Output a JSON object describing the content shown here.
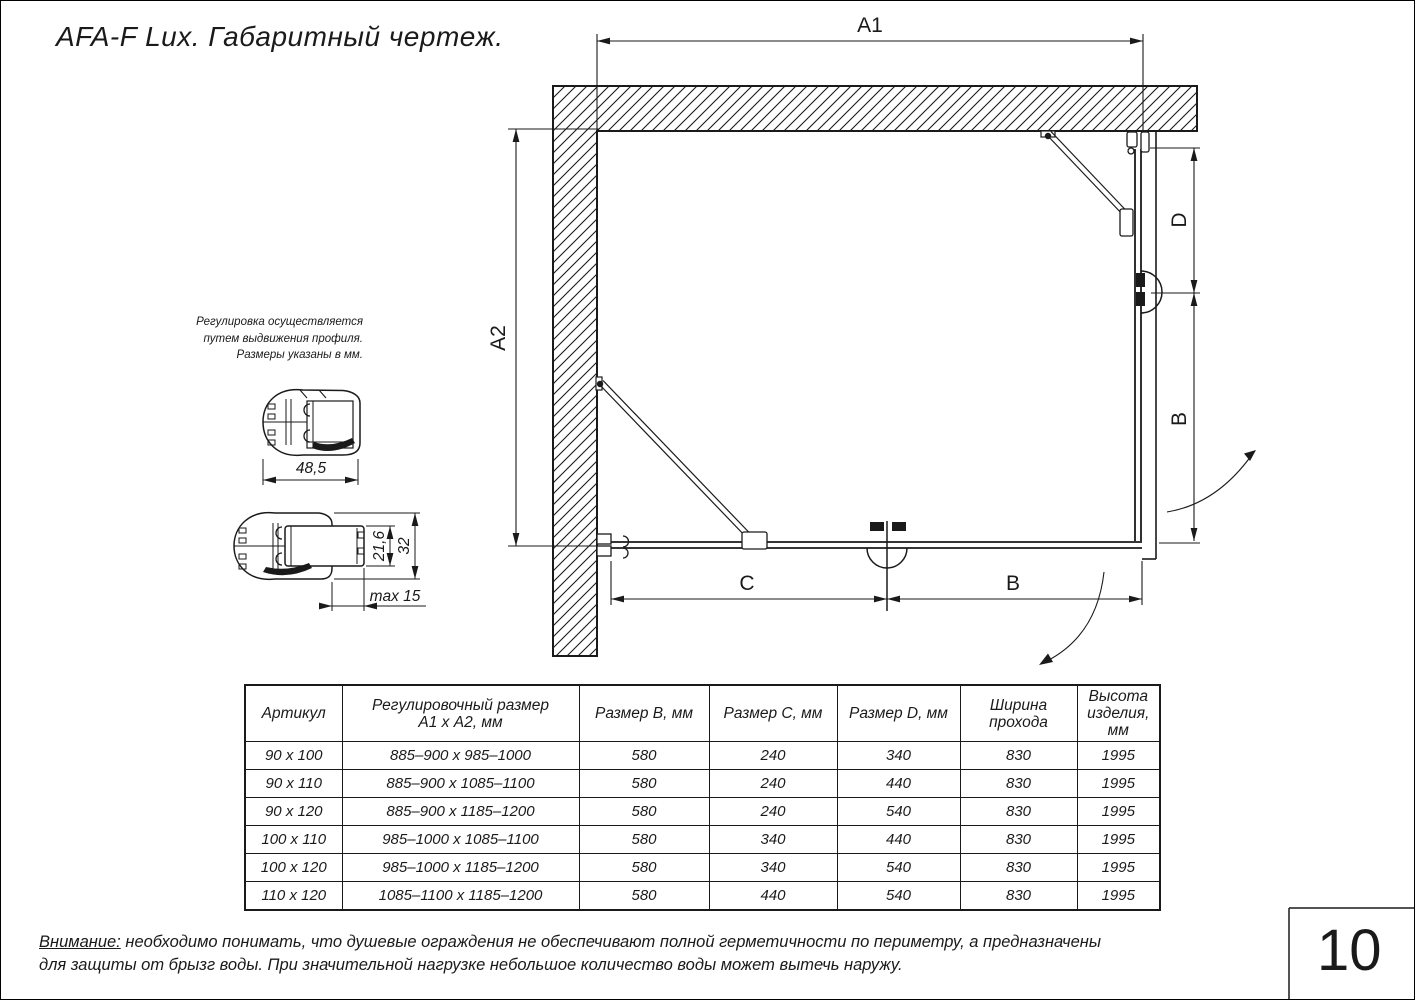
{
  "page": {
    "title": "AFA-F Lux. Габаритный чертеж.",
    "page_number": "10"
  },
  "drawing": {
    "dim_a1": "A1",
    "dim_a2": "A2",
    "dim_d": "D",
    "dim_b_right": "B",
    "dim_c": "C",
    "dim_b_bottom": "B"
  },
  "profiles": {
    "note_line1": "Регулировка осуществляется",
    "note_line2": "путем выдвижения профиля.",
    "note_line3": "Размеры указаны в мм.",
    "dim_width": "48,5",
    "dim_inner": "21,6",
    "dim_outer": "32",
    "dim_max": "max 15"
  },
  "table": {
    "headers": {
      "artikul": [
        "Артикул"
      ],
      "range": [
        "Регулировочный размер",
        "А1 х А2, мм"
      ],
      "size_b": [
        "Размер B, мм"
      ],
      "size_c": [
        "Размер C, мм"
      ],
      "size_d": [
        "Размер D, мм"
      ],
      "pass_width": [
        "Ширина",
        "прохода"
      ],
      "height": [
        "Высота",
        "изделия,",
        "мм"
      ]
    },
    "rows": [
      [
        "90 x 100",
        "885–900 x 985–1000",
        "580",
        "240",
        "340",
        "830",
        "1995"
      ],
      [
        "90 x 110",
        "885–900 x 1085–1100",
        "580",
        "240",
        "440",
        "830",
        "1995"
      ],
      [
        "90 x 120",
        "885–900 x 1185–1200",
        "580",
        "240",
        "540",
        "830",
        "1995"
      ],
      [
        "100 x 110",
        "985–1000 x 1085–1100",
        "580",
        "340",
        "440",
        "830",
        "1995"
      ],
      [
        "100 x 120",
        "985–1000 x 1185–1200",
        "580",
        "340",
        "540",
        "830",
        "1995"
      ],
      [
        "110 x 120",
        "1085–1100 x 1185–1200",
        "580",
        "440",
        "540",
        "830",
        "1995"
      ]
    ]
  },
  "footer": {
    "warning_label": "Внимание:",
    "warning_line1": " необходимо понимать, что душевые ограждения не обеспечивают полной герметичности по периметру, а предназначены",
    "warning_line2": "для защиты от брызг воды. При значительной нагрузке небольшое количество воды может вытечь наружу."
  }
}
